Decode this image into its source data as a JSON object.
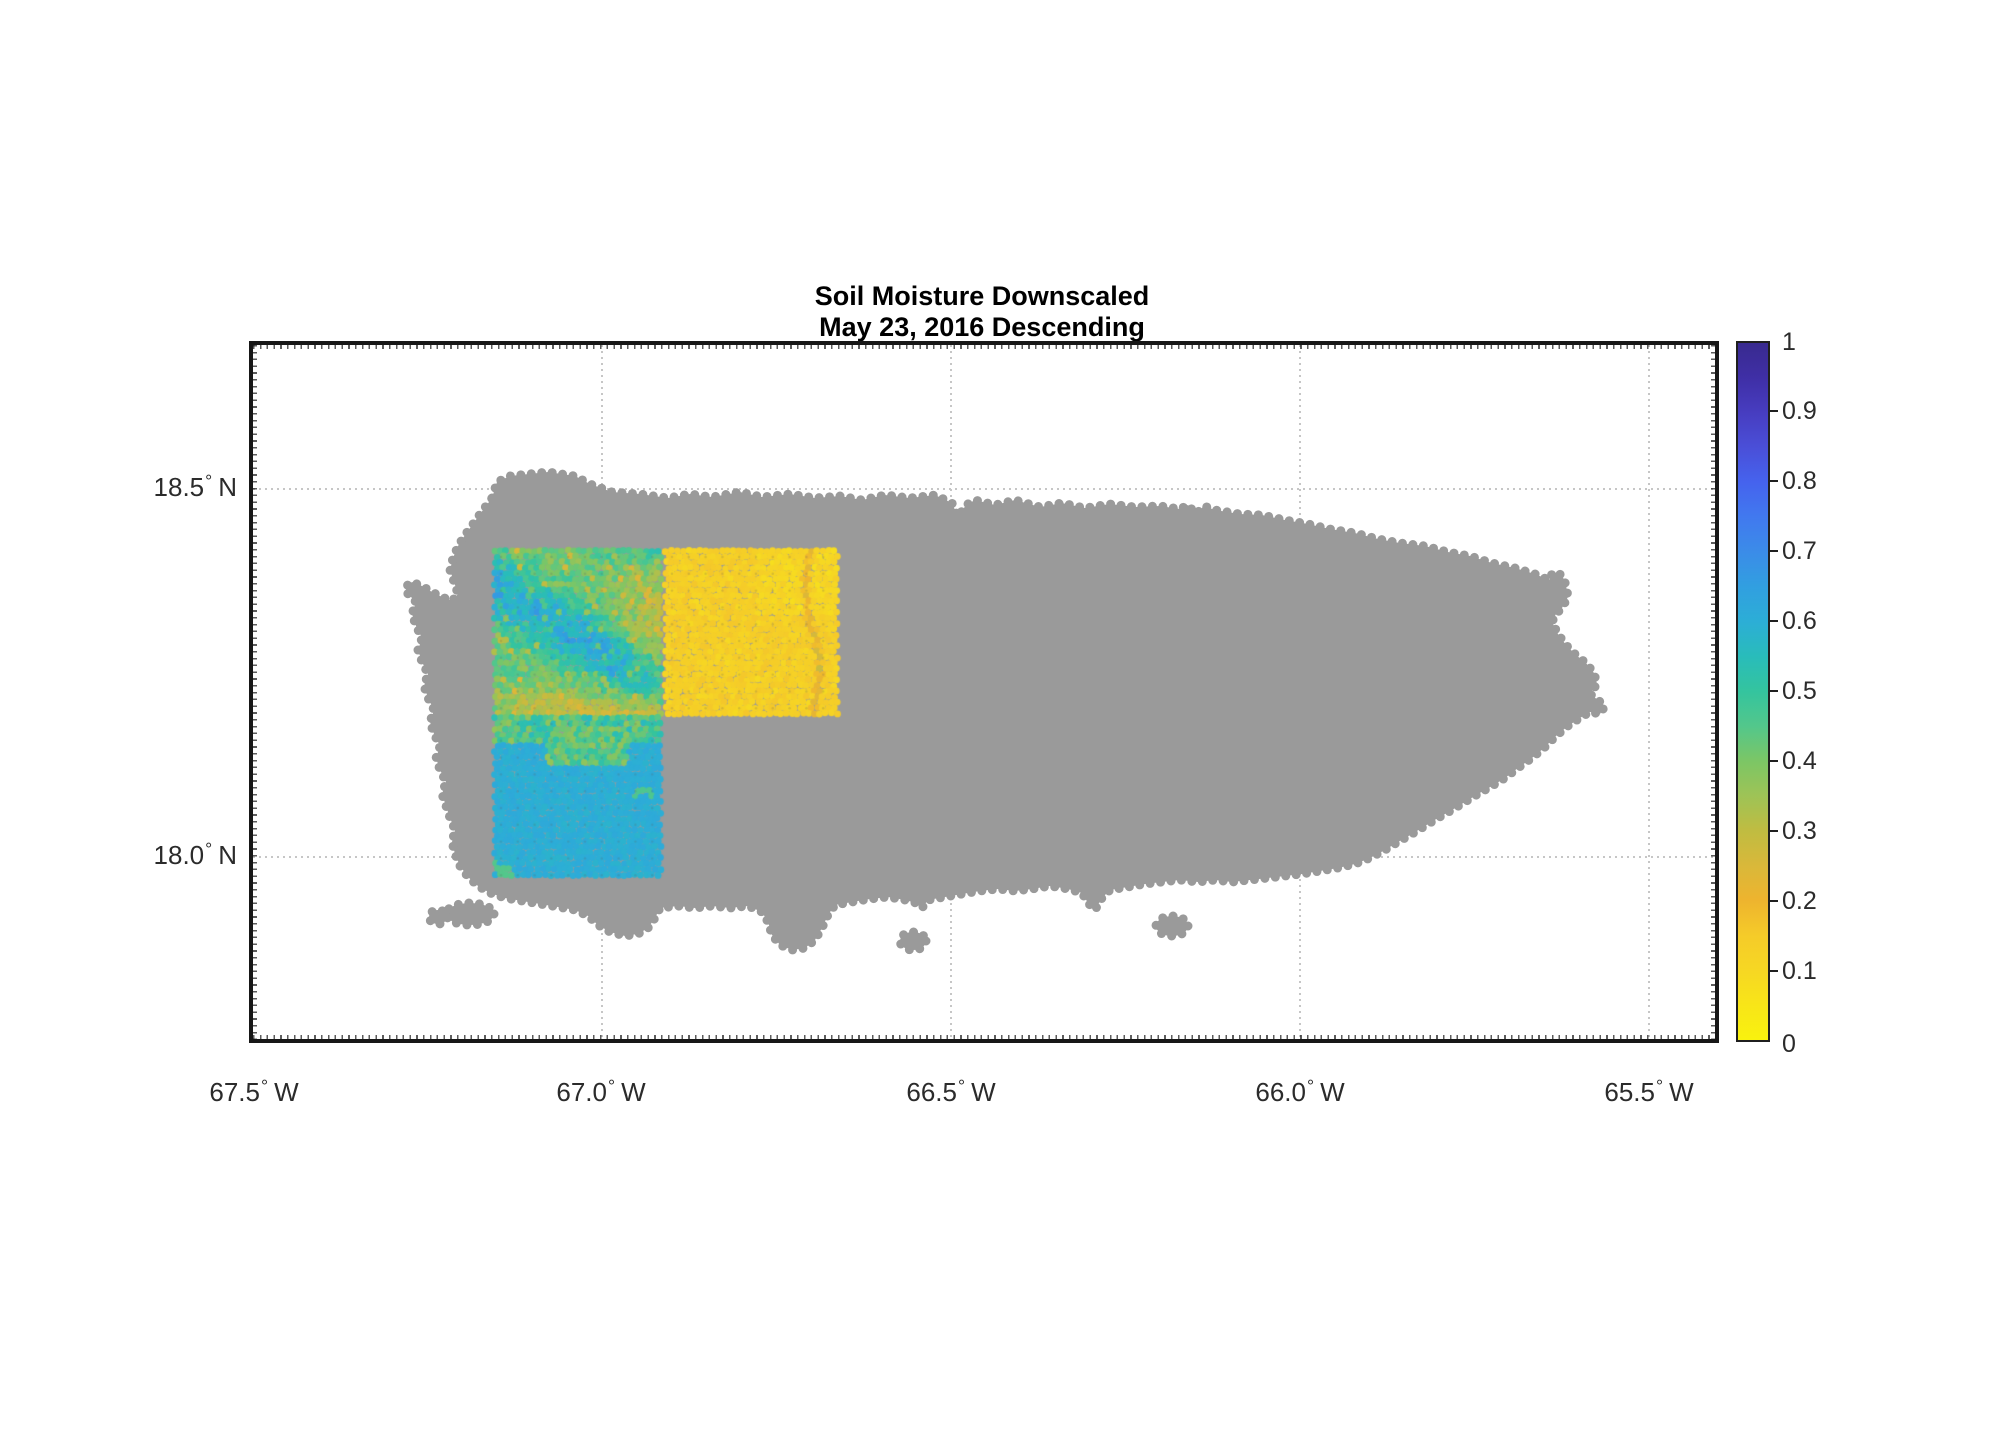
{
  "title": {
    "line1": "Soil Moisture Downscaled",
    "line2": "May 23, 2016 Descending"
  },
  "axes": {
    "x_ticks": [
      {
        "num": "67.5",
        "deg": "°",
        "hemi": "W"
      },
      {
        "num": "67.0",
        "deg": "°",
        "hemi": "W"
      },
      {
        "num": "66.5",
        "deg": "°",
        "hemi": "W"
      },
      {
        "num": "66.0",
        "deg": "°",
        "hemi": "W"
      },
      {
        "num": "65.5",
        "deg": "°",
        "hemi": "W"
      }
    ],
    "y_ticks": [
      {
        "num": "18.5",
        "deg": "°",
        "hemi": "N"
      },
      {
        "num": "18.0",
        "deg": "°",
        "hemi": "N"
      }
    ]
  },
  "colorbar": {
    "labels": [
      "1",
      "0.9",
      "0.8",
      "0.7",
      "0.6",
      "0.5",
      "0.4",
      "0.3",
      "0.2",
      "0.1",
      "0"
    ],
    "min": 0,
    "max": 1
  },
  "colors": {
    "land_gray": "#9a9a9a",
    "background": "#ffffff",
    "grid": "#c6c6c6",
    "frame": "#171717",
    "tick_label": "#2b2b2b",
    "colormap_stops": [
      [
        0.0,
        "#f9f20e"
      ],
      [
        0.05,
        "#f8e518"
      ],
      [
        0.1,
        "#f6d723"
      ],
      [
        0.15,
        "#f5cb29"
      ],
      [
        0.2,
        "#eeb42e"
      ],
      [
        0.25,
        "#d9b83a"
      ],
      [
        0.3,
        "#c0bc41"
      ],
      [
        0.35,
        "#9ec356"
      ],
      [
        0.4,
        "#7cc665"
      ],
      [
        0.45,
        "#53c78b"
      ],
      [
        0.5,
        "#34c49e"
      ],
      [
        0.55,
        "#29bcba"
      ],
      [
        0.6,
        "#2caed6"
      ],
      [
        0.65,
        "#319fe0"
      ],
      [
        0.7,
        "#3b8ce8"
      ],
      [
        0.75,
        "#4179ef"
      ],
      [
        0.8,
        "#4563ee"
      ],
      [
        0.85,
        "#4a4fd8"
      ],
      [
        0.9,
        "#473dc0"
      ],
      [
        0.95,
        "#3f2fa6"
      ],
      [
        1.0,
        "#392a8f"
      ]
    ]
  },
  "chart_data": {
    "type": "heatmap",
    "title": "Soil Moisture Downscaled",
    "subtitle": "May 23, 2016 Descending",
    "x_tick_labels": [
      "67.5° W",
      "67.0° W",
      "66.5° W",
      "66.0° W",
      "65.5° W"
    ],
    "y_tick_labels": [
      "18.5° N",
      "18.0° N"
    ],
    "xlim_lon_deg_west": [
      67.5,
      65.4
    ],
    "ylim_lat_deg_north": [
      17.75,
      18.7
    ],
    "grid": "dotted graticule at 0.5 degree spacing",
    "colorbar": {
      "label_range": [
        0,
        1
      ],
      "tick_step": 0.1,
      "colormap": "parula reversed (yellow=0, dark blue=1)",
      "position": "right"
    },
    "basemap": "Puerto Rico landmass shown as gray (no-data) dot field",
    "data_cells": [
      {
        "name": "northwest cell",
        "lon_w": [
          67.16,
          66.91
        ],
        "lat_n": [
          18.19,
          18.42
        ],
        "soil_moisture_range": [
          0.25,
          0.7
        ],
        "description": "mottled teal-green with diagonal blue streaks, yellow-green toward east and south edges"
      },
      {
        "name": "north-central cell",
        "lon_w": [
          66.91,
          66.66
        ],
        "lat_n": [
          18.19,
          18.42
        ],
        "soil_moisture_range": [
          0.08,
          0.25
        ],
        "description": "mostly uniform yellow-orange (dry) with faint olive streak near east edge"
      },
      {
        "name": "southwest cell",
        "lon_w": [
          67.16,
          66.91
        ],
        "lat_n": [
          17.97,
          18.19
        ],
        "soil_moisture_range": [
          0.4,
          0.65
        ],
        "description": "nearly uniform light blue (wet), green-teal mottling along its north edge"
      }
    ]
  }
}
